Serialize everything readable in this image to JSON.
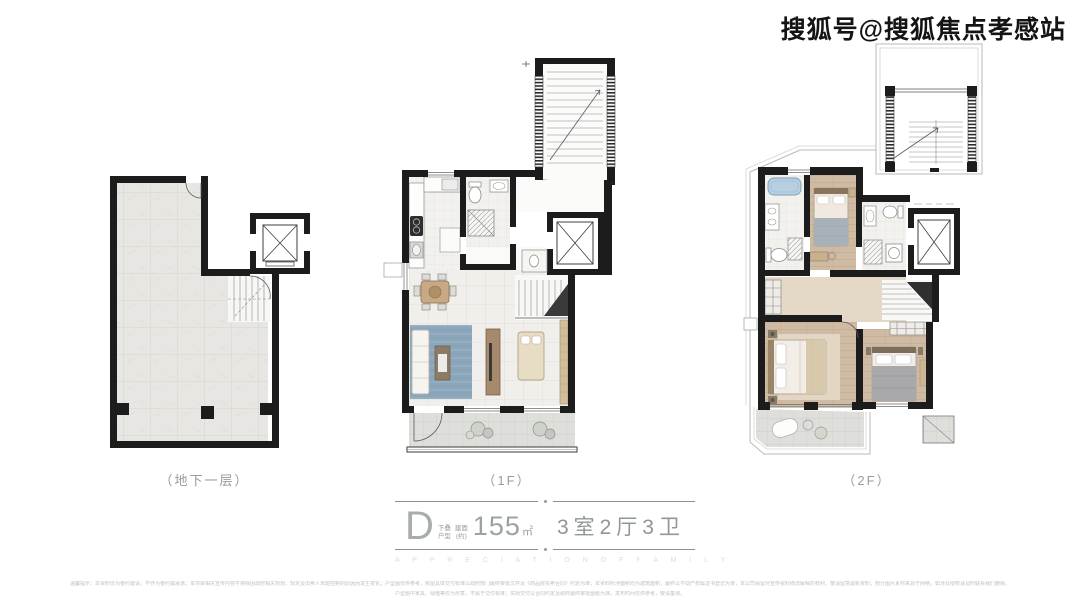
{
  "watermark": {
    "text": "搜狐号@搜狐焦点孝感站"
  },
  "plans": {
    "basement": {
      "label": "（地下一层）"
    },
    "f1": {
      "label": "（1F）"
    },
    "f2": {
      "label": "（2F）"
    }
  },
  "unit": {
    "type_letter": "D",
    "type_tag_top": "下叠",
    "type_tag_bottom": "户型",
    "area_tag_top": "建面",
    "area_tag_bottom": "(约)",
    "area_value": "155",
    "area_unit": "㎡",
    "rooms": "3室2厅3卫",
    "slogan_en": "A P P R E C I A T I O N   O F   F A M I L Y"
  },
  "footer": {
    "disclaimer_line1": "温馨提示：本资料仅为要约邀请，不作为要约或承诺；本项目相关宣传内容不排除因政府相关规划、规定及出卖人未能控制的原因而发生变化；户型图仅供参考，房屋具体交付标准以政府部门最终审批文件及《商品房买卖合同》约定为准；本资料所涉面积均为建筑面积，最终以不动产权属证书登记为准；本公司保留对宣传资料修改解释的权利，敬请留意最新资料；部分图片素材来源于网络，如涉及侵权请及时联系我们删除。",
    "disclaimer_line2": "户型图中家具、绿植等仅为示意，不属于交付标准；实际交付以合同约定及政府最终审批图纸为准。发布时间仅供参考，敬请垂询。"
  },
  "colors": {
    "wall": "#1c1c1c",
    "basement_tile": "#e7e6e2",
    "living_tile": "#f0efeb",
    "wood_floor": "#cfbba3",
    "rug_blue": "#8ba6ba",
    "tub_blue": "#b7cfe3",
    "label_gray": "#9b9b9b",
    "rule_gray": "#8f8f8f",
    "slogan_gray": "#dcdcda"
  }
}
